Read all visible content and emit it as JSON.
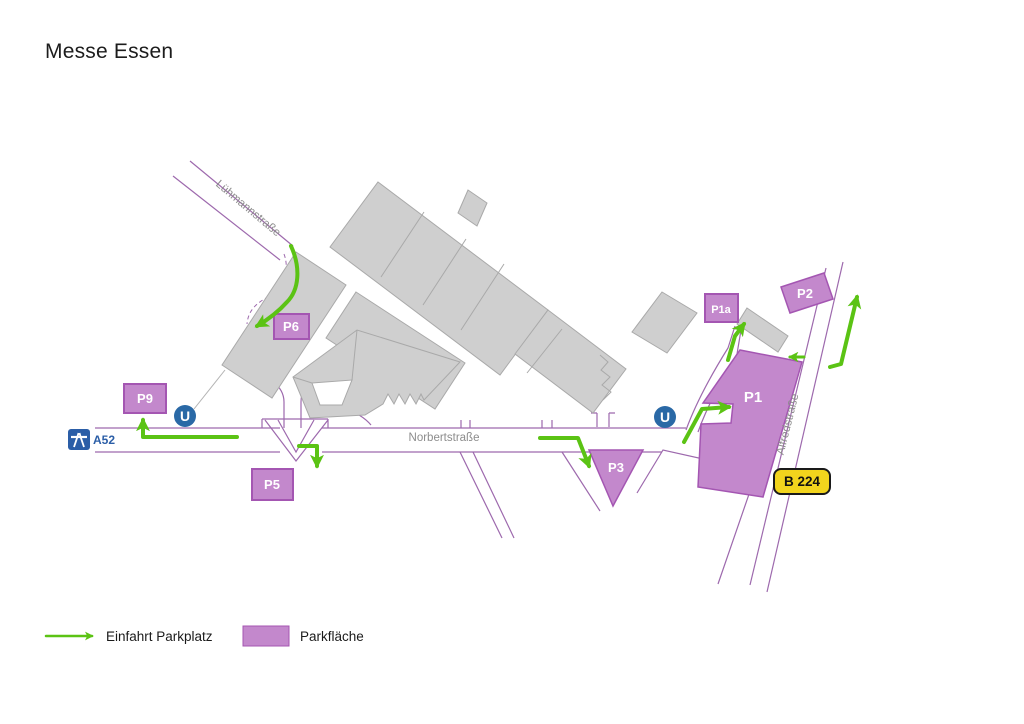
{
  "title": "Messe Essen",
  "streets": {
    "luhmannstrasse": "Lühmannstraße",
    "norbertstrasse": "Norbertstraße",
    "alfredstrasse": "Alfredstraße"
  },
  "road_badges": {
    "autobahn": "A52",
    "bundesstrasse": "B 224"
  },
  "stations": {
    "subway_symbol": "U"
  },
  "parking": {
    "p1": "P1",
    "p1a": "P1a",
    "p2": "P2",
    "p3": "P3",
    "p5": "P5",
    "p6": "P6",
    "p9": "P9"
  },
  "legend": {
    "entrance_label": "Einfahrt Parkplatz",
    "area_label": "Parkfläche"
  },
  "colors": {
    "parking_fill": "#c388cc",
    "parking_border": "#a456b2",
    "street_line": "#9d69ad",
    "entrance_arrow": "#5bc314",
    "building_fill": "#cfcfcf",
    "building_border": "#a9a9a9",
    "subway_blue": "#2a69a6",
    "autobahn_blue": "#2b5ea7",
    "bundesstrasse_yellow": "#f2d41d",
    "street_label_gray": "#8c8c8c"
  }
}
